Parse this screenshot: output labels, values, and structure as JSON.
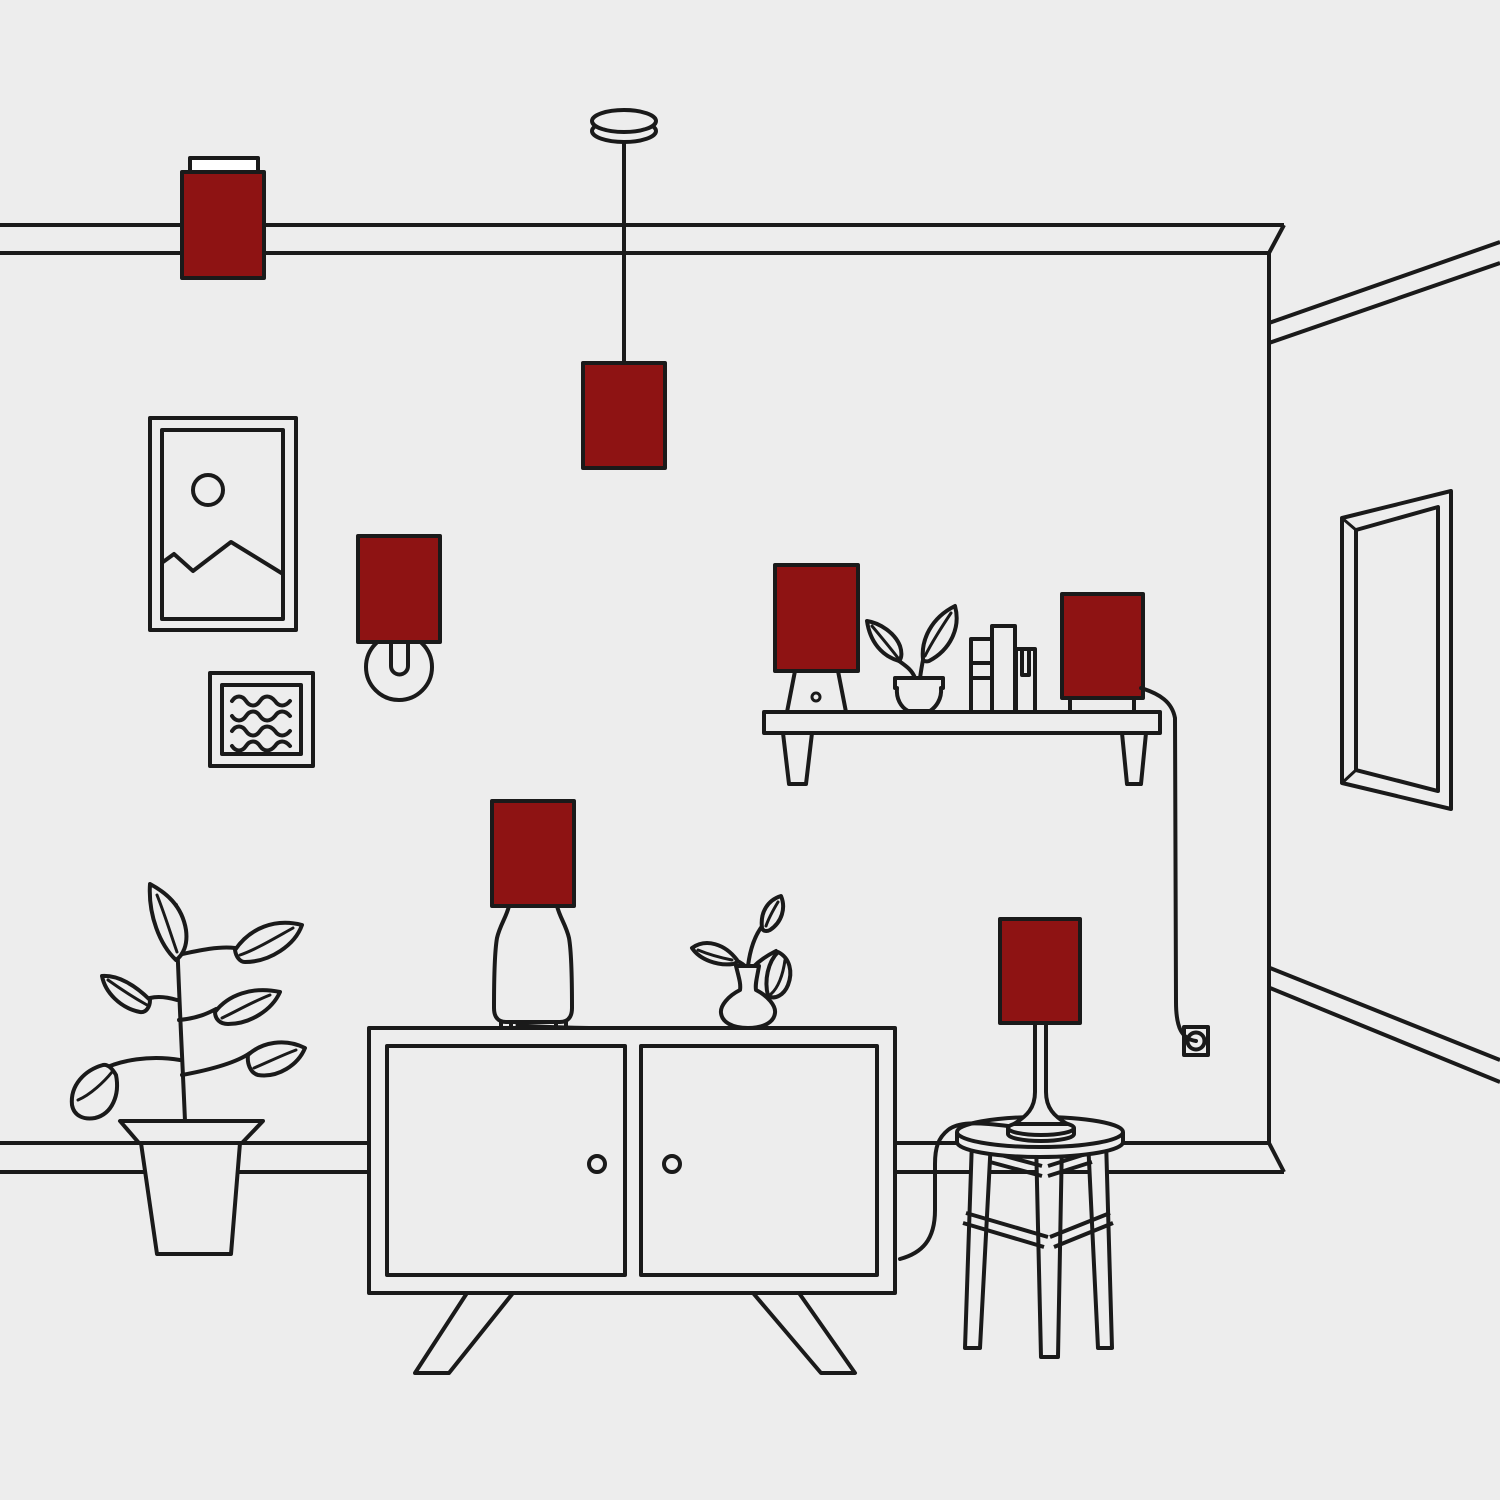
{
  "colors": {
    "background": "#EDEDED",
    "line": "#1A1A1A",
    "lamp_shade_red": "#8E1313",
    "plate_white": "#FFFFFF"
  },
  "objects": [
    {
      "name": "ceiling-mounted-lamp",
      "highlighted": true
    },
    {
      "name": "pendant-lamp",
      "highlighted": true
    },
    {
      "name": "wall-sconce-lamp",
      "highlighted": true
    },
    {
      "name": "framed-picture-mountains",
      "highlighted": false
    },
    {
      "name": "framed-art-waves",
      "highlighted": false
    },
    {
      "name": "wall-shelf",
      "highlighted": false
    },
    {
      "name": "shelf-table-lamp",
      "highlighted": true
    },
    {
      "name": "shelf-potted-plant",
      "highlighted": false
    },
    {
      "name": "books",
      "highlighted": false
    },
    {
      "name": "shelf-box-lamp",
      "highlighted": true
    },
    {
      "name": "power-outlet",
      "highlighted": false
    },
    {
      "name": "wall-mirror",
      "highlighted": false
    },
    {
      "name": "floor-plant",
      "highlighted": false
    },
    {
      "name": "sideboard",
      "highlighted": false
    },
    {
      "name": "table-lamp-bell-base",
      "highlighted": true
    },
    {
      "name": "vase-with-branches",
      "highlighted": false
    },
    {
      "name": "side-table",
      "highlighted": false
    },
    {
      "name": "table-lamp-stick-base",
      "highlighted": true
    }
  ]
}
